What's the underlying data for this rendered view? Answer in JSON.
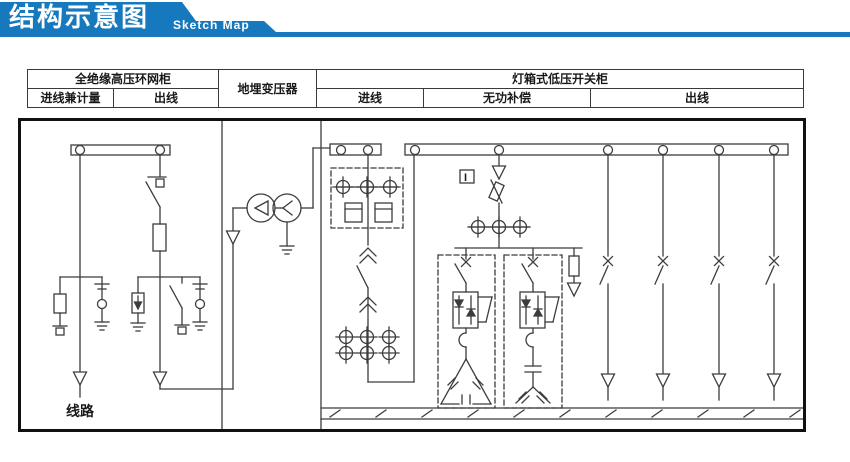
{
  "header": {
    "title": "结构示意图",
    "subtitle": "Sketch Map"
  },
  "table": {
    "hv_cabinet": "全绝缘高压环网柜",
    "transformer": "地埋变压器",
    "lv_cabinet": "灯箱式低压开关柜",
    "hv_incoming_metering": "进线兼计量",
    "hv_outgoing": "出线",
    "lv_incoming": "进线",
    "reactive_compensation": "无功补偿",
    "lv_outgoing": "出线"
  },
  "diagram": {
    "line_label": "线路",
    "indicator_label": "I"
  },
  "colors": {
    "accent_blue": "#1779bd",
    "schematic_line": "#3c3c3c",
    "border_black": "#111111"
  }
}
